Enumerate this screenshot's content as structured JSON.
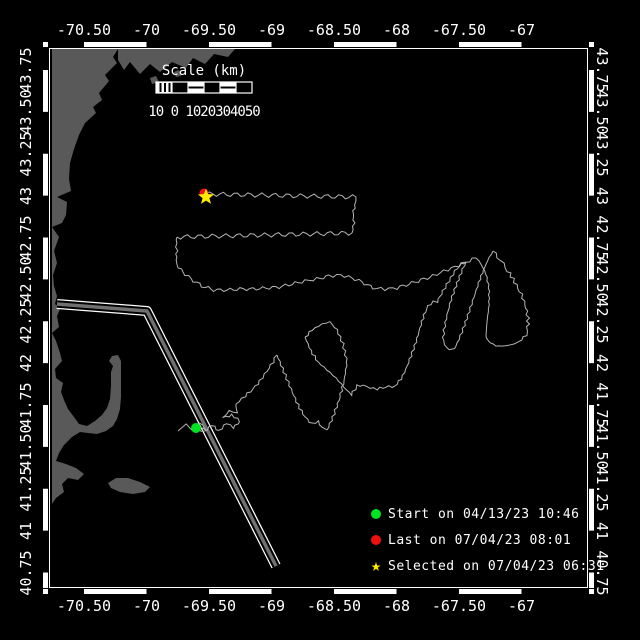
{
  "app": {
    "description": "Glider track map, Gulf of Maine"
  },
  "colors": {
    "background": "#000000",
    "frame": "#ffffff",
    "land": "#595959",
    "ocean": "#000000",
    "track": "#b4b4b4",
    "lane_center": "#707070",
    "start_green": "#00e321",
    "last_red": "#f01010",
    "selected_yellow": "#ffec00"
  },
  "axes": {
    "lon_labels": [
      "-70.50",
      "-70",
      "-69.50",
      "-69",
      "-68.50",
      "-68",
      "-67.50",
      "-67"
    ],
    "lon_ticks": [
      -70.5,
      -70,
      -69.5,
      -69,
      -68.5,
      -68,
      -67.5,
      -67
    ],
    "lat_labels": [
      "43.75",
      "43.50",
      "43.25",
      "43",
      "42.75",
      "42.50",
      "42.25",
      "42",
      "41.75",
      "41.50",
      "41.25",
      "41",
      "40.75"
    ],
    "lat_ticks": [
      43.75,
      43.5,
      43.25,
      43,
      42.75,
      42.5,
      42.25,
      42,
      41.75,
      41.5,
      41.25,
      41,
      40.75
    ]
  },
  "scalebar": {
    "title": "Scale (km)",
    "tick_text": "10 0 1020304050"
  },
  "legend": [
    {
      "marker": "circle",
      "color": "#00e321",
      "label": "Start on 04/13/23 10:46"
    },
    {
      "marker": "circle",
      "color": "#f01010",
      "label": "Last on 07/04/23 08:01"
    },
    {
      "marker": "star",
      "color": "#ffec00",
      "label": "Selected on 07/04/23 06:31"
    }
  ],
  "markers": [
    {
      "name": "start-marker",
      "shape": "circle",
      "color": "#00e321",
      "x": 196,
      "y": 428,
      "r": 5
    },
    {
      "name": "last-marker",
      "shape": "circle",
      "color": "#f01010",
      "x": 204,
      "y": 193,
      "r": 4.5
    },
    {
      "name": "selected-marker",
      "shape": "star",
      "color": "#ffec00",
      "x": 206,
      "y": 197,
      "r": 8.5
    }
  ],
  "map": {
    "calibration": {
      "lon0": -70.5,
      "x0": 84,
      "px_per_lon": 125,
      "lat0": 43.75,
      "y0": 70,
      "px_per_lat": 167.5,
      "frame": [
        49,
        48,
        588,
        588
      ]
    },
    "land": [
      [
        [
          52,
          49
        ],
        [
          118,
          49
        ],
        [
          113,
          57
        ],
        [
          117,
          63
        ],
        [
          105,
          75
        ],
        [
          109,
          81
        ],
        [
          99,
          93
        ],
        [
          102,
          100
        ],
        [
          93,
          107
        ],
        [
          96,
          113
        ],
        [
          85,
          123
        ],
        [
          79,
          135
        ],
        [
          74,
          149
        ],
        [
          70,
          163
        ],
        [
          69,
          179
        ],
        [
          71,
          191
        ],
        [
          57,
          197
        ],
        [
          67,
          202
        ],
        [
          66,
          215
        ],
        [
          62,
          223
        ],
        [
          52,
          227
        ],
        [
          59,
          237
        ],
        [
          54,
          251
        ],
        [
          57,
          263
        ],
        [
          53,
          275
        ],
        [
          54,
          286
        ],
        [
          57,
          296
        ],
        [
          55,
          304
        ],
        [
          60,
          309
        ],
        [
          57,
          316
        ],
        [
          59,
          327
        ],
        [
          52,
          333
        ],
        [
          56,
          341
        ],
        [
          60,
          353
        ],
        [
          62,
          361
        ],
        [
          55,
          369
        ],
        [
          56,
          378
        ],
        [
          63,
          383
        ],
        [
          61,
          392
        ],
        [
          64,
          400
        ],
        [
          68,
          409
        ],
        [
          74,
          417
        ],
        [
          79,
          424
        ],
        [
          87,
          426
        ],
        [
          95,
          421
        ],
        [
          102,
          415
        ],
        [
          107,
          408
        ],
        [
          110,
          399
        ],
        [
          111,
          386
        ],
        [
          111,
          372
        ],
        [
          113,
          366
        ],
        [
          109,
          361
        ],
        [
          112,
          356
        ],
        [
          118,
          355
        ],
        [
          121,
          361
        ],
        [
          121,
          371
        ],
        [
          121,
          384
        ],
        [
          121,
          397
        ],
        [
          120,
          409
        ],
        [
          117,
          419
        ],
        [
          113,
          426
        ],
        [
          106,
          431
        ],
        [
          97,
          434
        ],
        [
          88,
          433
        ],
        [
          80,
          432
        ],
        [
          72,
          437
        ],
        [
          64,
          445
        ],
        [
          59,
          453
        ],
        [
          56,
          461
        ],
        [
          66,
          464
        ],
        [
          76,
          468
        ],
        [
          84,
          474
        ],
        [
          78,
          480
        ],
        [
          68,
          478
        ],
        [
          62,
          484
        ],
        [
          64,
          492
        ],
        [
          56,
          498
        ],
        [
          52,
          504
        ]
      ],
      [
        [
          118,
          49
        ],
        [
          235,
          49
        ],
        [
          228,
          57
        ],
        [
          214,
          54
        ],
        [
          205,
          64
        ],
        [
          193,
          58
        ],
        [
          186,
          68
        ],
        [
          172,
          62
        ],
        [
          160,
          72
        ],
        [
          150,
          64
        ],
        [
          140,
          74
        ],
        [
          130,
          62
        ],
        [
          124,
          70
        ],
        [
          118,
          60
        ]
      ],
      [
        [
          150,
          78
        ],
        [
          156,
          76
        ],
        [
          159,
          82
        ],
        [
          152,
          84
        ]
      ],
      [
        [
          163,
          88
        ],
        [
          169,
          86
        ],
        [
          171,
          92
        ],
        [
          165,
          93
        ]
      ],
      [
        [
          174,
          72
        ],
        [
          179,
          70
        ],
        [
          181,
          76
        ],
        [
          176,
          77
        ]
      ],
      [
        [
          108,
          483
        ],
        [
          116,
          478
        ],
        [
          128,
          478
        ],
        [
          140,
          482
        ],
        [
          150,
          487
        ],
        [
          145,
          492
        ],
        [
          133,
          494
        ],
        [
          120,
          492
        ],
        [
          111,
          488
        ]
      ]
    ],
    "lane": [
      [
        57,
        304
      ],
      [
        147,
        311
      ],
      [
        276,
        566
      ]
    ],
    "track_segments": [
      {
        "amp": 1.0,
        "wl": 7,
        "pts": [
          [
            178,
            431
          ],
          [
            186,
            424
          ],
          [
            193,
            431
          ],
          [
            200,
            423
          ],
          [
            207,
            430
          ],
          [
            199,
            427
          ],
          [
            196,
            428
          ],
          [
            204,
            432
          ],
          [
            212,
            425
          ],
          [
            219,
            431
          ],
          [
            227,
            423
          ],
          [
            233,
            428
          ],
          [
            240,
            421
          ],
          [
            232,
            415
          ],
          [
            223,
            418
          ],
          [
            229,
            411
          ],
          [
            237,
            413
          ],
          [
            236,
            404
          ]
        ]
      },
      {
        "amp": 1.2,
        "wl": 9,
        "pts": [
          [
            236,
            404
          ],
          [
            245,
            396
          ],
          [
            253,
            389
          ],
          [
            260,
            381
          ],
          [
            267,
            371
          ],
          [
            273,
            362
          ],
          [
            277,
            355
          ]
        ]
      },
      {
        "amp": 1.2,
        "wl": 8,
        "pts": [
          [
            277,
            355
          ],
          [
            284,
            372
          ],
          [
            291,
            389
          ],
          [
            298,
            405
          ],
          [
            305,
            417
          ],
          [
            312,
            424
          ],
          [
            318,
            421
          ],
          [
            322,
            428
          ],
          [
            327,
            430
          ]
        ]
      },
      {
        "amp": 1.2,
        "wl": 8,
        "pts": [
          [
            327,
            430
          ],
          [
            333,
            417
          ],
          [
            339,
            400
          ],
          [
            344,
            381
          ],
          [
            347,
            362
          ],
          [
            343,
            344
          ],
          [
            337,
            330
          ],
          [
            330,
            322
          ],
          [
            322,
            324
          ],
          [
            312,
            330
          ],
          [
            305,
            337
          ]
        ]
      },
      {
        "amp": 1.2,
        "wl": 8,
        "pts": [
          [
            305,
            337
          ],
          [
            311,
            351
          ],
          [
            318,
            362
          ],
          [
            327,
            370
          ],
          [
            336,
            378
          ],
          [
            344,
            387
          ],
          [
            351,
            395
          ],
          [
            357,
            386
          ],
          [
            363,
            385
          ],
          [
            370,
            388
          ],
          [
            377,
            389
          ],
          [
            386,
            387
          ],
          [
            395,
            386
          ]
        ]
      },
      {
        "amp": 1.0,
        "wl": 8,
        "pts": [
          [
            395,
            386
          ],
          [
            401,
            379
          ],
          [
            406,
            369
          ],
          [
            411,
            356
          ],
          [
            416,
            342
          ],
          [
            420,
            328
          ],
          [
            424,
            315
          ],
          [
            428,
            306
          ],
          [
            433,
            302
          ],
          [
            437,
            302
          ],
          [
            443,
            291
          ],
          [
            449,
            281
          ],
          [
            455,
            271
          ],
          [
            461,
            264
          ],
          [
            466,
            262
          ]
        ]
      },
      {
        "amp": 1.0,
        "wl": 7,
        "pts": [
          [
            466,
            262
          ],
          [
            461,
            273
          ],
          [
            456,
            286
          ],
          [
            451,
            300
          ],
          [
            447,
            315
          ],
          [
            444,
            330
          ],
          [
            443,
            341
          ],
          [
            447,
            348
          ],
          [
            452,
            350
          ],
          [
            456,
            346
          ]
        ]
      },
      {
        "amp": 1.0,
        "wl": 7,
        "pts": [
          [
            456,
            346
          ],
          [
            462,
            332
          ],
          [
            468,
            315
          ],
          [
            474,
            297
          ],
          [
            480,
            279
          ],
          [
            486,
            264
          ],
          [
            491,
            254
          ],
          [
            493,
            251
          ]
        ]
      },
      {
        "amp": 1.5,
        "wl": 6,
        "pts": [
          [
            493,
            251
          ],
          [
            498,
            257
          ],
          [
            503,
            264
          ],
          [
            508,
            271
          ],
          [
            513,
            279
          ],
          [
            518,
            288
          ],
          [
            523,
            298
          ],
          [
            526,
            308
          ],
          [
            528,
            318
          ],
          [
            528,
            327
          ],
          [
            526,
            335
          ],
          [
            522,
            340
          ]
        ]
      },
      {
        "amp": 0.8,
        "wl": 6,
        "pts": [
          [
            522,
            340
          ],
          [
            514,
            344
          ],
          [
            505,
            346
          ],
          [
            496,
            346
          ],
          [
            488,
            341
          ],
          [
            486,
            336
          ]
        ]
      },
      {
        "amp": 1.0,
        "wl": 7,
        "pts": [
          [
            486,
            336
          ],
          [
            487,
            322
          ],
          [
            489,
            305
          ],
          [
            489,
            288
          ],
          [
            486,
            274
          ],
          [
            481,
            264
          ],
          [
            476,
            258
          ]
        ]
      },
      {
        "amp": 1.6,
        "wl": 11,
        "pts": [
          [
            476,
            258
          ],
          [
            466,
            262
          ],
          [
            455,
            267
          ],
          [
            444,
            271
          ],
          [
            433,
            276
          ],
          [
            421,
            280
          ],
          [
            409,
            284
          ],
          [
            397,
            288
          ],
          [
            385,
            289
          ],
          [
            373,
            288
          ],
          [
            362,
            282
          ],
          [
            352,
            278
          ],
          [
            341,
            275
          ],
          [
            329,
            276
          ],
          [
            317,
            279
          ],
          [
            305,
            281
          ],
          [
            292,
            284
          ],
          [
            279,
            287
          ],
          [
            266,
            288
          ],
          [
            253,
            289
          ],
          [
            240,
            289
          ],
          [
            227,
            290
          ],
          [
            214,
            290
          ],
          [
            202,
            286
          ],
          [
            191,
            279
          ],
          [
            183,
            272
          ],
          [
            178,
            268
          ]
        ]
      },
      {
        "amp": 1.0,
        "wl": 8,
        "pts": [
          [
            178,
            268
          ],
          [
            176,
            260
          ],
          [
            177,
            251
          ],
          [
            176,
            243
          ],
          [
            177,
            237
          ]
        ]
      },
      {
        "amp": 2.2,
        "wl": 13,
        "pts": [
          [
            177,
            237
          ],
          [
            352,
            233
          ]
        ]
      },
      {
        "amp": 1.0,
        "wl": 8,
        "pts": [
          [
            352,
            233
          ],
          [
            354,
            223
          ],
          [
            353,
            214
          ],
          [
            355,
            205
          ],
          [
            356,
            197
          ]
        ]
      },
      {
        "amp": 2.2,
        "wl": 13,
        "pts": [
          [
            356,
            197
          ],
          [
            206,
            194
          ]
        ]
      }
    ]
  }
}
